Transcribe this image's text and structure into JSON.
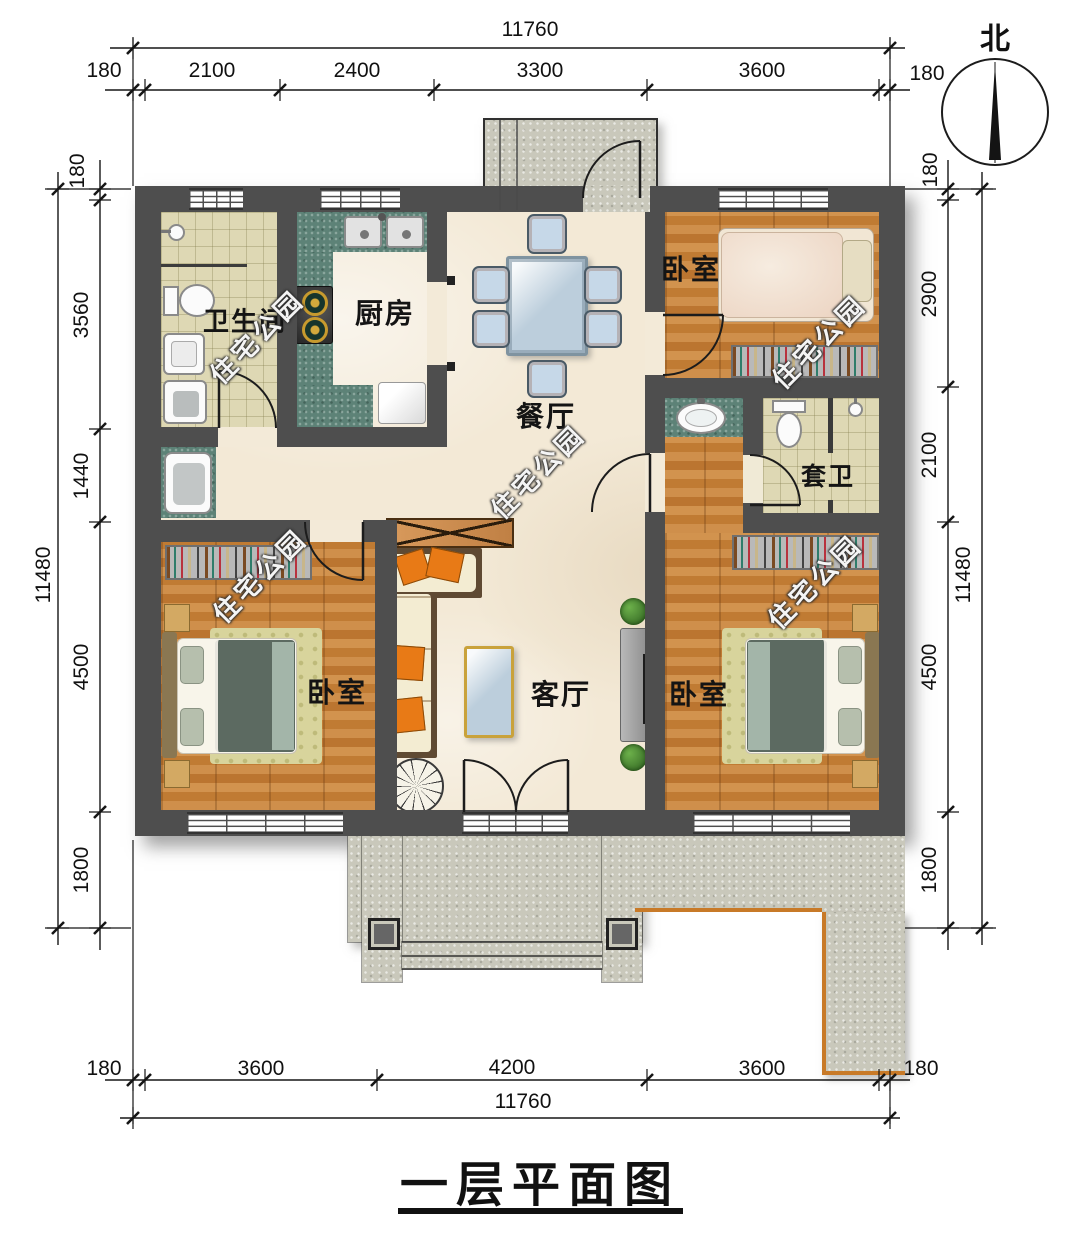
{
  "title": {
    "text": "一层平面图"
  },
  "compass": {
    "label": "北"
  },
  "watermark": {
    "text": "住宅公园"
  },
  "rooms": {
    "bathroom": {
      "label": "卫生间"
    },
    "kitchen": {
      "label": "厨房"
    },
    "dining": {
      "label": "餐厅"
    },
    "bedroom_top_right": {
      "label": "卧室"
    },
    "ensuite_bath": {
      "label": "套卫"
    },
    "bedroom_left": {
      "label": "卧室"
    },
    "living_room": {
      "label": "客厅"
    },
    "bedroom_right": {
      "label": "卧室"
    }
  },
  "dimensions": {
    "top": {
      "total": "11760",
      "offset_left": "180",
      "seg_2100": "2100",
      "seg_2400": "2400",
      "seg_3300": "3300",
      "seg_3600": "3600",
      "offset_right": "180"
    },
    "bottom": {
      "total": "11760",
      "offset_left": "180",
      "seg_3600_left": "3600",
      "seg_4200": "4200",
      "seg_3600_right": "3600",
      "offset_right": "180"
    },
    "left": {
      "total": "11480",
      "offset_top": "180",
      "seg_3560": "3560",
      "seg_1440": "1440",
      "seg_4500": "4500",
      "seg_1800": "1800"
    },
    "right": {
      "total": "11480",
      "offset_top": "180",
      "seg_2900": "2900",
      "seg_2100": "2100",
      "seg_4500": "4500",
      "seg_1800": "1800"
    }
  },
  "colors": {
    "wall": "#4e4e4e",
    "wood_floor": "#c5813a",
    "counter_teal": "#5d8277",
    "marble": "#f3e9d6",
    "tile": "#ded8b4",
    "stone": "#c9c8bb",
    "accent_orange": "#e87a16",
    "walkway_edge": "#c87a28"
  }
}
